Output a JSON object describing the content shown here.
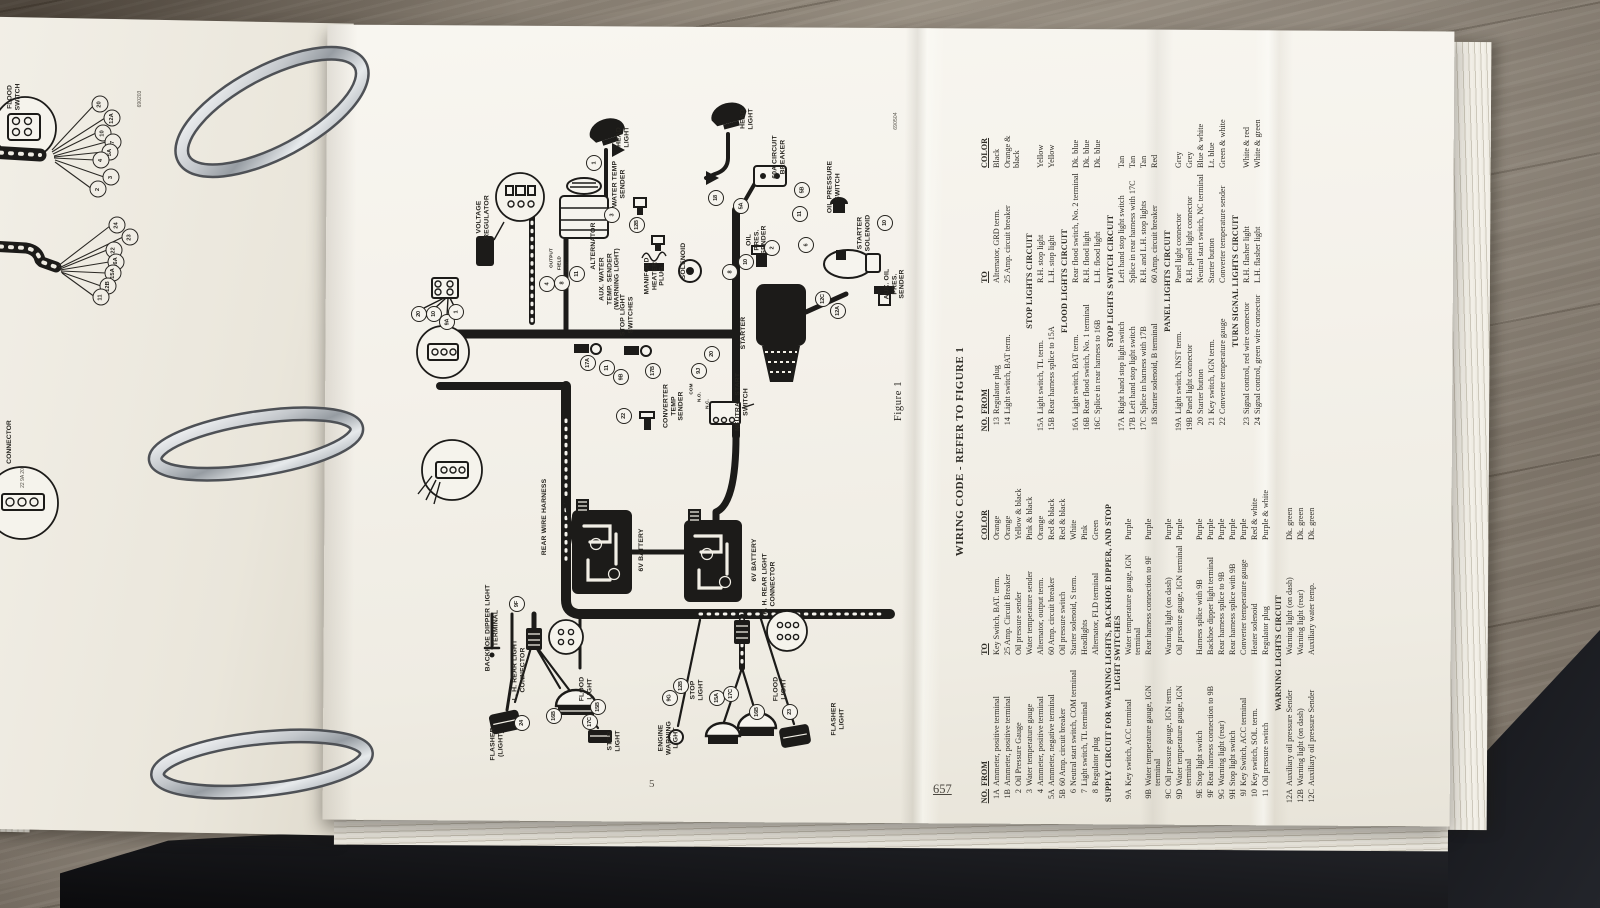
{
  "left_page": {
    "code": "690203",
    "flood_switch_label": "FLOOD\nSWITCH",
    "connector_label": "CONNECTOR",
    "connector_pins": "22  9A  20",
    "fan1": [
      {
        "n": "20",
        "x": 100,
        "y": 104
      },
      {
        "n": "12A",
        "x": 112,
        "y": 118
      },
      {
        "n": "10",
        "x": 103,
        "y": 133
      },
      {
        "n": "7",
        "x": 113,
        "y": 142
      },
      {
        "n": "5A",
        "x": 110,
        "y": 152
      },
      {
        "n": "4",
        "x": 101,
        "y": 160
      },
      {
        "n": "3",
        "x": 111,
        "y": 177
      },
      {
        "n": "2",
        "x": 98,
        "y": 189
      }
    ],
    "fan2": [
      {
        "n": "24",
        "x": 117,
        "y": 225
      },
      {
        "n": "23",
        "x": 130,
        "y": 237
      },
      {
        "n": "22",
        "x": 114,
        "y": 250
      },
      {
        "n": "16A",
        "x": 116,
        "y": 262
      },
      {
        "n": "15A",
        "x": 113,
        "y": 273
      },
      {
        "n": "12B",
        "x": 108,
        "y": 286
      },
      {
        "n": "11",
        "x": 101,
        "y": 297
      }
    ]
  },
  "main_page": {
    "code": "690504",
    "figure_label": "Figure 1",
    "page_number": "5",
    "binder_page_number": "657",
    "diagram": {
      "labels": [
        {
          "t": "HEAD\nLIGHT",
          "x": 623,
          "y": 137
        },
        {
          "t": "HEAD\nLIGHT",
          "x": 747,
          "y": 119
        },
        {
          "t": "VOLTAGE\nREGULATOR",
          "x": 483,
          "y": 217
        },
        {
          "t": "WATER TEMP\nSENDER",
          "x": 619,
          "y": 184
        },
        {
          "t": "ALTERNATOR",
          "x": 594,
          "y": 246
        },
        {
          "t": "OUTPUT",
          "x": 551,
          "y": 258,
          "s": 4.6
        },
        {
          "t": "FIELD",
          "x": 559,
          "y": 263,
          "s": 4.6
        },
        {
          "t": "GND",
          "x": 567,
          "y": 267,
          "s": 4.6
        },
        {
          "t": "AUX. WATER\nTEMP. SENDER\n(WARNING LIGHT)",
          "x": 610,
          "y": 279
        },
        {
          "t": "MANIFOLD\nHEATER\nPLUG",
          "x": 655,
          "y": 276
        },
        {
          "t": "SOLENOID",
          "x": 684,
          "y": 261
        },
        {
          "t": "60A CIRCUIT\nBREAKER",
          "x": 779,
          "y": 157
        },
        {
          "t": "OIL PRESSURE\nSWITCH",
          "x": 834,
          "y": 187
        },
        {
          "t": "OIL\nPRES.\nSENDER",
          "x": 757,
          "y": 240
        },
        {
          "t": "STARTER\nSOLENOID",
          "x": 864,
          "y": 233
        },
        {
          "t": "STARTER",
          "x": 744,
          "y": 333
        },
        {
          "t": "AUX. OIL\nPRES.\nSENDER",
          "x": 895,
          "y": 284
        },
        {
          "t": "STOP LIGHT\nSWITCHES",
          "x": 627,
          "y": 315
        },
        {
          "t": "CONVERTER\nTEMP\nSENDER",
          "x": 674,
          "y": 406
        },
        {
          "t": "NEUTRAL START\nSWITCH",
          "x": 742,
          "y": 402
        },
        {
          "t": "COM",
          "x": 691,
          "y": 389,
          "s": 4.6
        },
        {
          "t": "N.O.",
          "x": 699,
          "y": 397,
          "s": 4.6
        },
        {
          "t": "N.C.",
          "x": 707,
          "y": 404,
          "s": 4.6
        },
        {
          "t": "REAR WIRE HARNESS",
          "x": 545,
          "y": 517
        },
        {
          "t": "6V BATTERY",
          "x": 642,
          "y": 550
        },
        {
          "t": "6V BATTERY",
          "x": 755,
          "y": 560
        },
        {
          "t": "R. H. REAR LIGHT\nCONNECTOR",
          "x": 769,
          "y": 584
        },
        {
          "t": "BACKHOE DIPPER LIGHT\nTERMINAL",
          "x": 492,
          "y": 628
        },
        {
          "t": "L. H. REAR LIGHT\nCONNECTOR",
          "x": 519,
          "y": 670
        },
        {
          "t": "FLOOD\nLIGHT",
          "x": 586,
          "y": 689
        },
        {
          "t": "FLOOD\nLIGHT",
          "x": 780,
          "y": 689
        },
        {
          "t": "STOP\nLIGHT",
          "x": 614,
          "y": 741
        },
        {
          "t": "STOP\nLIGHT",
          "x": 697,
          "y": 690
        },
        {
          "t": "FLASHER\n(LIGHT)",
          "x": 497,
          "y": 744
        },
        {
          "t": "FLASHER\nLIGHT",
          "x": 838,
          "y": 719
        },
        {
          "t": "ENGINE\nWARNING\nLIGHT",
          "x": 669,
          "y": 738
        },
        {
          "t": "Figure 1",
          "x": 899,
          "y": 401,
          "cls": "fig"
        },
        {
          "t": "690504",
          "x": 897,
          "y": 121,
          "cls": "tiny"
        }
      ],
      "callouts": [
        {
          "n": "1",
          "x": 594,
          "y": 163
        },
        {
          "n": "3",
          "x": 612,
          "y": 215
        },
        {
          "n": "12B",
          "x": 637,
          "y": 225
        },
        {
          "n": "11",
          "x": 577,
          "y": 274
        },
        {
          "n": "8",
          "x": 562,
          "y": 283
        },
        {
          "n": "4",
          "x": 547,
          "y": 284
        },
        {
          "n": "18",
          "x": 716,
          "y": 198
        },
        {
          "n": "5A",
          "x": 741,
          "y": 206
        },
        {
          "n": "5B",
          "x": 802,
          "y": 190
        },
        {
          "n": "11",
          "x": 800,
          "y": 214
        },
        {
          "n": "2",
          "x": 772,
          "y": 248
        },
        {
          "n": "10",
          "x": 746,
          "y": 262
        },
        {
          "n": "8",
          "x": 730,
          "y": 272
        },
        {
          "n": "6",
          "x": 806,
          "y": 245
        },
        {
          "n": "10",
          "x": 885,
          "y": 223
        },
        {
          "n": "12C",
          "x": 823,
          "y": 299
        },
        {
          "n": "12A",
          "x": 838,
          "y": 311
        },
        {
          "n": "20",
          "x": 419,
          "y": 314
        },
        {
          "n": "10",
          "x": 434,
          "y": 314
        },
        {
          "n": "9A",
          "x": 447,
          "y": 322
        },
        {
          "n": "1",
          "x": 456,
          "y": 312
        },
        {
          "n": "17A",
          "x": 588,
          "y": 363
        },
        {
          "n": "11",
          "x": 607,
          "y": 368
        },
        {
          "n": "9B",
          "x": 621,
          "y": 377
        },
        {
          "n": "17B",
          "x": 653,
          "y": 371
        },
        {
          "n": "20",
          "x": 712,
          "y": 354
        },
        {
          "n": "9J",
          "x": 699,
          "y": 371
        },
        {
          "n": "22",
          "x": 624,
          "y": 416
        },
        {
          "n": "9F",
          "x": 517,
          "y": 604
        },
        {
          "n": "24",
          "x": 522,
          "y": 723
        },
        {
          "n": "16B",
          "x": 554,
          "y": 716
        },
        {
          "n": "17C",
          "x": 590,
          "y": 722
        },
        {
          "n": "15B",
          "x": 598,
          "y": 707
        },
        {
          "n": "12B",
          "x": 681,
          "y": 686
        },
        {
          "n": "9G",
          "x": 670,
          "y": 698
        },
        {
          "n": "15A",
          "x": 717,
          "y": 698
        },
        {
          "n": "17C",
          "x": 731,
          "y": 694
        },
        {
          "n": "16B",
          "x": 757,
          "y": 712
        },
        {
          "n": "23",
          "x": 790,
          "y": 712
        }
      ]
    },
    "table": {
      "title": "WIRING CODE - REFER TO FIGURE 1",
      "headers": [
        "NO.",
        "FROM",
        "TO",
        "COLOR"
      ],
      "left_sections": [
        {
          "heading": "",
          "rows": [
            [
              "1A",
              "Ammeter, positive terminal",
              "Key Switch, BAT. term.",
              "Orange"
            ],
            [
              "1B",
              "Ammeter, positive terminal",
              "25 Amp. Circuit Breaker",
              "Orange"
            ],
            [
              "2",
              "Oil Pressure Gauge",
              "Oil pressure sender",
              "Yellow & black"
            ],
            [
              "3",
              "Water temperature gauge",
              "Water temperature sender",
              "Pink & black"
            ],
            [
              "4",
              "Ammeter, positive terminal",
              "Alternator, output term.",
              "Orange"
            ],
            [
              "5A",
              "Ammeter, negative terminal",
              "60 Amp. circuit breaker",
              "Red & black"
            ],
            [
              "5B",
              "60 Amp. circuit breaker",
              "Oil pressure switch",
              "Red & black"
            ],
            [
              "6",
              "Neutral start switch, COM terminal",
              "Starter solenoid, S term.",
              "White"
            ],
            [
              "7",
              "Light switch, TL terminal",
              "Headlights",
              "Pink"
            ],
            [
              "8",
              "Regulator plug",
              "Alternator, FLD terminal",
              "Green"
            ]
          ]
        },
        {
          "heading": "SUPPLY CIRCUIT FOR WARNING LIGHTS, BACKHOE DIPPER, AND STOP LIGHT SWITCHES",
          "rows": [
            [
              "9A",
              "Key switch, ACC terminal",
              "Water temperature gauge, IGN terminal",
              "Purple"
            ],
            [
              "9B",
              "Water temperature gauge, IGN terminal",
              "Rear harness connection to 9F",
              "Purple"
            ],
            [
              "9C",
              "Oil pressure gauge, IGN term.",
              "Warning light (on dash)",
              "Purple"
            ],
            [
              "9D",
              "Water temperature gauge, IGN terminal",
              "Oil pressure gauge, IGN terminal",
              "Purple"
            ],
            [
              "9E",
              "Stop light switch",
              "Harness splice with 9B",
              "Purple"
            ],
            [
              "9F",
              "Rear harness connection to 9B",
              "Backhoe dipper light terminal",
              "Purple"
            ],
            [
              "9G",
              "Warning light (rear)",
              "Rear harness splice to 9B",
              "Purple"
            ],
            [
              "9H",
              "Stop light switch",
              "Rear harness splice with 9B",
              "Purple"
            ],
            [
              "9J",
              "Key Switch, ACC terminal",
              "Converter temperature gauge",
              "Purple"
            ],
            [
              "10",
              "Key switch, SOL. term.",
              "Heater solenoid",
              "Red & white"
            ],
            [
              "11",
              "Oil pressure switch",
              "Regulator plug",
              "Purple & white"
            ]
          ]
        },
        {
          "heading": "WARNING LIGHTS CIRCUIT",
          "rows": [
            [
              "12A",
              "Auxiliary oil pressure Sender",
              "Warning light (on dash)",
              "Dk. green"
            ],
            [
              "12B",
              "Warning light (on dash)",
              "Warning light (rear)",
              "Dk. green"
            ],
            [
              "12C",
              "Auxiliary oil pressure Sender",
              "Auxiliary water temp.",
              "Dk. green"
            ]
          ]
        }
      ],
      "right_sections": [
        {
          "heading": "",
          "rows": [
            [
              "13",
              "Regulator plug",
              "Alternator, GRD term.",
              "Black"
            ],
            [
              "14",
              "Light switch, BAT term.",
              "25 Amp. circuit breaker",
              "Orange & black"
            ]
          ]
        },
        {
          "heading": "STOP LIGHTS CIRCUIT",
          "rows": [
            [
              "15A",
              "Light switch, TL term.",
              "R.H. stop light",
              "Yellow"
            ],
            [
              "15B",
              "Rear harness splice to 15A",
              "L.H. stop light",
              "Yellow"
            ]
          ]
        },
        {
          "heading": "FLOOD LIGHTS CIRCUIT",
          "rows": [
            [
              "16A",
              "Light switch, BAT term.",
              "Rear flood switch, No. 2 terminal",
              "Dk. blue"
            ],
            [
              "16B",
              "Rear flood switch, No. 1 terminal",
              "R.H. flood light",
              "Dk. blue"
            ],
            [
              "16C",
              "Splice in rear harness to 16B",
              "L.H. flood light",
              "Dk. blue"
            ]
          ]
        },
        {
          "heading": "STOP LIGHTS SWITCH CIRCUIT",
          "rows": [
            [
              "17A",
              "Right hand stop light switch",
              "Left hand stop light switch",
              "Tan"
            ],
            [
              "17B",
              "Left hand stop light switch",
              "Splice in rear harness with 17C",
              "Tan"
            ],
            [
              "17C",
              "Splice in harness with 17B",
              "R.H. and L.H. stop lights",
              "Tan"
            ],
            [
              "18",
              "Starter solenoid, B terminal",
              "60 Amp. circuit breaker",
              "Red"
            ]
          ]
        },
        {
          "heading": "PANEL LIGHTS CIRCUIT",
          "rows": [
            [
              "19A",
              "Light switch, INST term.",
              "Panel light connector",
              "Grey"
            ],
            [
              "19B",
              "Panel light connector",
              "R.H. panel light connector",
              "Grey"
            ],
            [
              "20",
              "Starter button",
              "Neutral start switch, NC terminal",
              "Blue & white"
            ],
            [
              "21",
              "Key switch, IGN term.",
              "Starter button",
              "Lt. blue"
            ],
            [
              "22",
              "Converter temperature gauge",
              "Converter temperature sender",
              "Green & white"
            ]
          ]
        },
        {
          "heading": "TURN SIGNAL LIGHTS CIRCUIT",
          "rows": [
            [
              "23",
              "Signal control, red wire connector",
              "R.H. flasher light",
              "White & red"
            ],
            [
              "24",
              "Signal control, green wire connector",
              "L.H. flasher light",
              "White & green"
            ]
          ]
        }
      ]
    }
  }
}
